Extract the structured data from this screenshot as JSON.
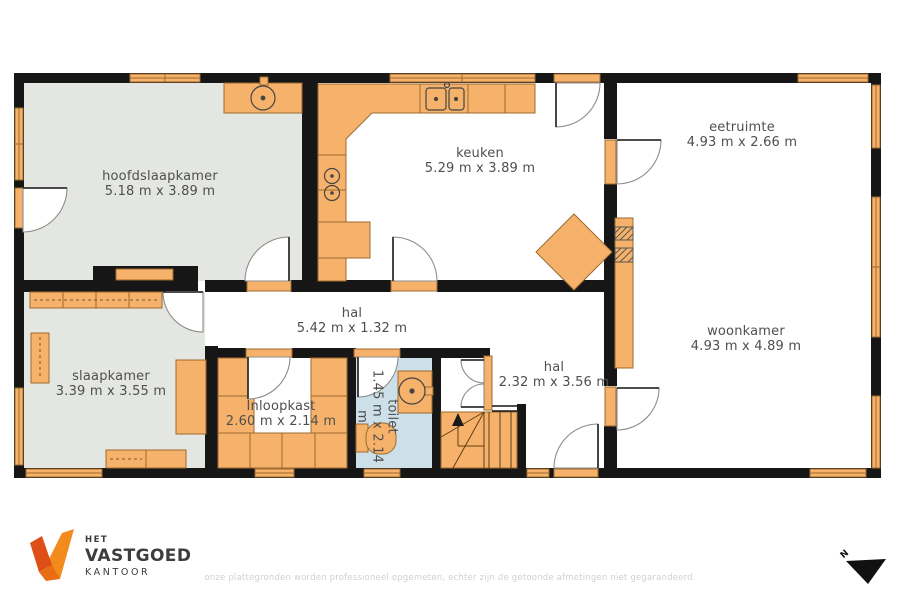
{
  "plan": {
    "rooms": [
      {
        "name": "hoofdslaapkamer",
        "dims": "5.18 m x 3.89 m"
      },
      {
        "name": "keuken",
        "dims": "5.29 m x 3.89 m"
      },
      {
        "name": "eetruimte",
        "dims": "4.93 m x 2.66 m"
      },
      {
        "name": "woonkamer",
        "dims": "4.93 m x 4.89 m"
      },
      {
        "name": "hal",
        "dims": "5.42 m x 1.32 m"
      },
      {
        "name": "slaapkamer",
        "dims": "3.39 m x 3.55 m"
      },
      {
        "name": "Inloopkast",
        "dims": "2.60 m x 2.14 m"
      },
      {
        "name": "toilet",
        "dims": "1.45 m x 2.14 m"
      },
      {
        "name": "hal",
        "dims": "2.32 m x 3.56 m"
      }
    ]
  },
  "branding": {
    "line1": "HET",
    "line2": "VASTGOED",
    "line3": "KANTOOR"
  },
  "compass": {
    "label": "N"
  },
  "footer": {
    "disclaimer": "onze plattegronden worden professioneel opgemeten, echter zijn de getoonde afmetingen niet gegarandeerd."
  },
  "icons": {
    "logo_mark": "orange V checkmark",
    "north_arrow": "black triangle pointing north-west",
    "sink": "circle with drain dot",
    "stove": "two burner circles",
    "toilet_fixture": "tank and bowl",
    "stairs": "treads with up arrow"
  },
  "colors": {
    "wall": "#161616",
    "furniture_orange": "#f6b26a",
    "furniture_outline": "#9c6b2f",
    "floor_gray": "#e4e6e2",
    "floor_toilet_blue": "#cddfe9",
    "door_arc": "#8c8c8c",
    "label_text": "#4f4f4f",
    "logo_orange_dark": "#dd4f17",
    "logo_orange_bright": "#f28b1c",
    "disclaimer_text": "#d0d0d0"
  }
}
